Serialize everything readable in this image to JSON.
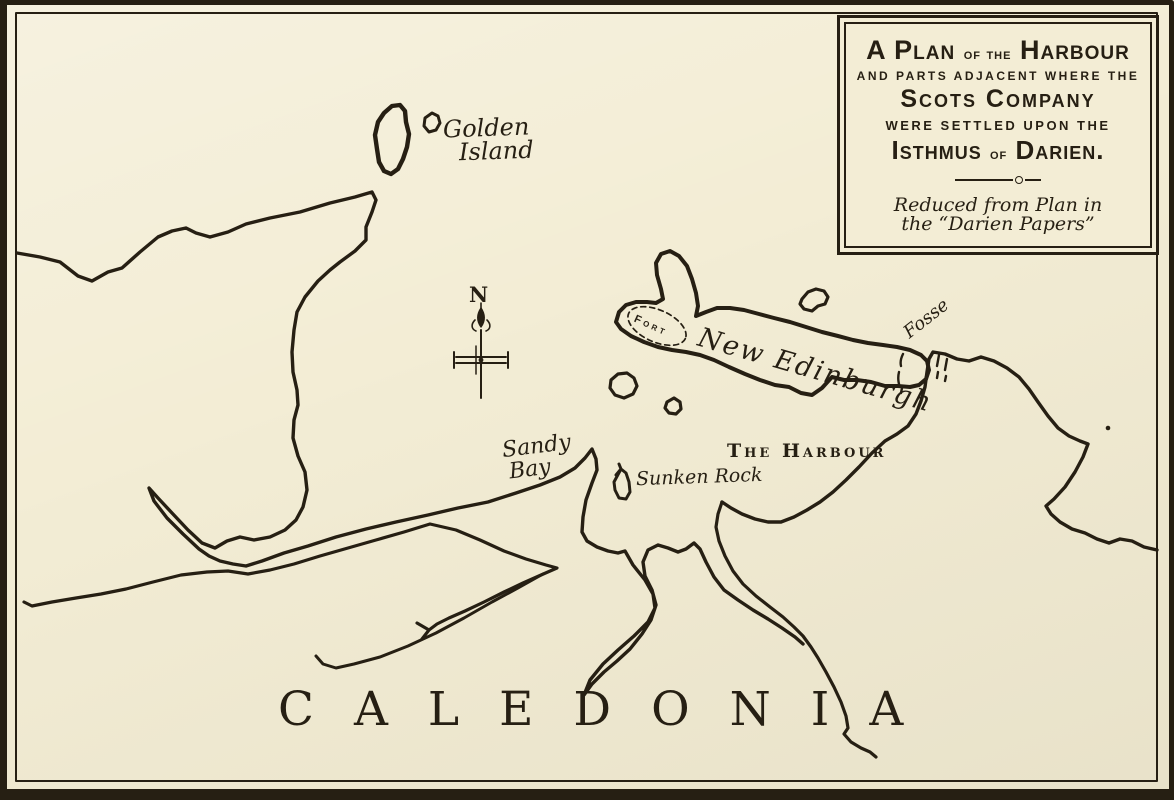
{
  "colors": {
    "paper": "#f3edd5",
    "ink": "#261f13"
  },
  "cartouche": {
    "line1_a": "A Plan",
    "line1_b": "of the",
    "line1_c": "Harbour",
    "line2": "AND PARTS ADJACENT WHERE THE",
    "line3": "Scots Company",
    "line4": "WERE SETTLED UPON THE",
    "line5_a": "Isthmus",
    "line5_b": "of",
    "line5_c": "Darien.",
    "credit_line1": "Reduced from Plan in",
    "credit_line2": "the “Darien Papers”"
  },
  "labels": {
    "golden_island_line1": "Golden",
    "golden_island_line2": "Island",
    "new_edinburgh": "New Edinburgh",
    "fort": "Fort",
    "fosse": "Fosse",
    "the_harbour": "The Harbour",
    "sandy_bay_line1": "Sandy",
    "sandy_bay_line2": "Bay",
    "sunken_rock": "Sunken Rock",
    "region": "CALEDONIA",
    "compass_north": "N"
  }
}
